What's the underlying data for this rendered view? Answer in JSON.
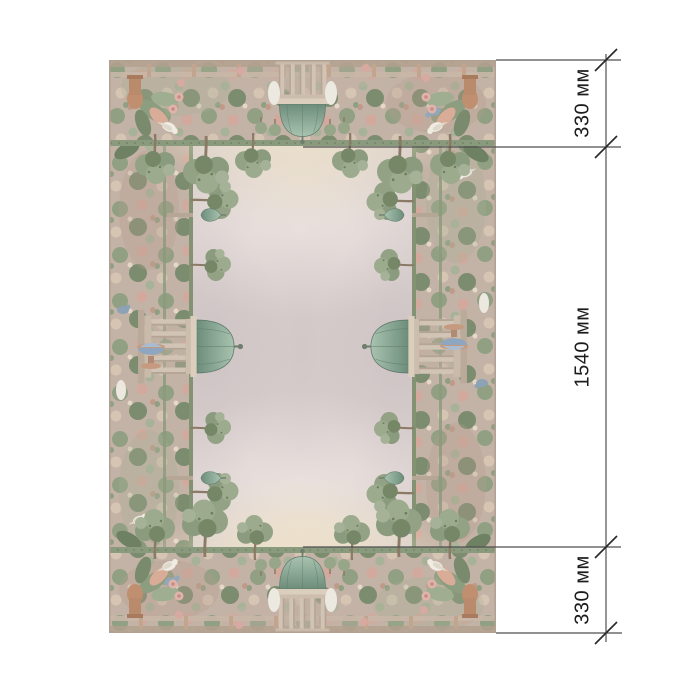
{
  "page": {
    "background": "#ffffff"
  },
  "product_image": {
    "kind": "decorative-panel-preview",
    "motifs": [
      "classical-garden-border",
      "trees",
      "gazebo-with-verdigris-dome",
      "rotunda-and-fountain",
      "white-birds",
      "foliage-and-blossoms"
    ],
    "palette": {
      "field": "#d9cfce",
      "border_base": "#c3b2a6",
      "foliage_green": "#8d9d7f",
      "dome_teal": "#7fa08e",
      "blossom_pink": "#d8aca1",
      "fountain_blue": "#8ea6bf"
    }
  },
  "dimension_annotations": {
    "unit": "мм",
    "line_color": "#4f4f4f",
    "tick_color": "#2a2a2a",
    "text_color": "#1c1c1c",
    "segments": [
      {
        "name": "top-border-height",
        "label": "330 мм"
      },
      {
        "name": "center-field-height",
        "label": "1540 мм"
      },
      {
        "name": "bottom-border-height",
        "label": "330 мм"
      }
    ]
  }
}
